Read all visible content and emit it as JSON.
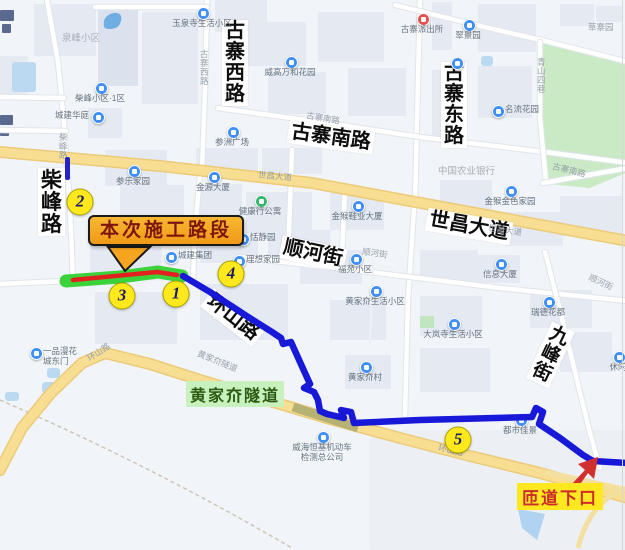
{
  "colors": {
    "route_blue": "#1818D8",
    "construction_red": "#E32020",
    "construction_glow_green": "#3BD23B",
    "callout_bg": "#F5A51F",
    "callout_text": "#7D1608",
    "badge_bg": "#FFE81C",
    "badge_text": "#1C1C66",
    "tunnel_label_bg": "#C8F1BE",
    "tunnel_label_text": "#2E5B13",
    "ramp_label_bg": "#FFE81F",
    "ramp_label_text": "#CB2B2B",
    "arrow_red": "#D23030"
  },
  "callout": {
    "text": "本次施工路段"
  },
  "tunnel": {
    "text": "黄家夼隧道"
  },
  "ramp": {
    "text": "匝道下口"
  },
  "badges": [
    {
      "n": "1",
      "x": 176,
      "y": 294
    },
    {
      "n": "2",
      "x": 80,
      "y": 202
    },
    {
      "n": "3",
      "x": 122,
      "y": 296
    },
    {
      "n": "4",
      "x": 231,
      "y": 274
    },
    {
      "n": "5",
      "x": 458,
      "y": 440
    }
  ],
  "major_road_labels": [
    {
      "t": "古寨西路",
      "x": 222,
      "y": 20,
      "v": true,
      "r": 0,
      "fs": 20
    },
    {
      "t": "古寨东路",
      "x": 441,
      "y": 62,
      "v": true,
      "r": 0,
      "fs": 20
    },
    {
      "t": "柴峰路",
      "x": 38,
      "y": 168,
      "v": true,
      "r": 0,
      "fs": 21
    },
    {
      "t": "古寨南路",
      "x": 288,
      "y": 126,
      "v": false,
      "r": 8,
      "fs": 20
    },
    {
      "t": "世昌大道",
      "x": 426,
      "y": 215,
      "v": false,
      "r": 10,
      "fs": 20
    },
    {
      "t": "顺河街",
      "x": 280,
      "y": 242,
      "v": false,
      "r": 12,
      "fs": 20
    },
    {
      "t": "环山路",
      "x": 200,
      "y": 306,
      "v": false,
      "r": 38,
      "fs": 20
    },
    {
      "t": "九峰街",
      "x": 538,
      "y": 324,
      "v": true,
      "r": 25,
      "fs": 19
    }
  ],
  "minor_road_labels": [
    {
      "t": "柴峰路",
      "x": 59,
      "y": 133,
      "r": 0,
      "v": true
    },
    {
      "t": "古寨西路",
      "x": 200,
      "y": 50,
      "r": 0,
      "v": true
    },
    {
      "t": "世昌大道",
      "x": 258,
      "y": 172,
      "r": 5,
      "v": false
    },
    {
      "t": "世昌大道",
      "x": 488,
      "y": 226,
      "r": 8,
      "v": false
    },
    {
      "t": "古寨南路",
      "x": 306,
      "y": 114,
      "r": 10,
      "v": false
    },
    {
      "t": "古寨南路",
      "x": 552,
      "y": 166,
      "r": 14,
      "v": false
    },
    {
      "t": "顺河街",
      "x": 362,
      "y": 249,
      "r": 8,
      "v": false
    },
    {
      "t": "顺河街",
      "x": 588,
      "y": 278,
      "r": 25,
      "v": false
    },
    {
      "t": "环山路",
      "x": 86,
      "y": 348,
      "r": -33,
      "v": false
    },
    {
      "t": "环山路",
      "x": 438,
      "y": 446,
      "r": 12,
      "v": false
    },
    {
      "t": "黄家夼隧道",
      "x": 196,
      "y": 357,
      "r": 22,
      "v": false
    },
    {
      "t": "青山四巷",
      "x": 537,
      "y": 58,
      "r": 0,
      "v": true
    },
    {
      "t": "草寨园",
      "x": 588,
      "y": 23,
      "r": 0,
      "v": false
    }
  ],
  "area_labels": [
    {
      "t": "泉峰小区",
      "x": 62,
      "y": 30
    },
    {
      "t": "中国农业银行",
      "x": 438,
      "y": 163
    }
  ],
  "pois": [
    {
      "lines": [
        "玉泉寺生活小区"
      ],
      "x": 202,
      "y": 12,
      "c": "blue",
      "p": "below"
    },
    {
      "lines": [
        "柴峰小区·1区"
      ],
      "x": 100,
      "y": 87,
      "c": "blue",
      "p": "below"
    },
    {
      "lines": [
        "城建华庭"
      ],
      "x": 97,
      "y": 116,
      "c": "blue",
      "p": "left"
    },
    {
      "lines": [
        "威高万和花园"
      ],
      "x": 290,
      "y": 61,
      "c": "blue",
      "p": "below"
    },
    {
      "lines": [
        "古寨派出所"
      ],
      "x": 422,
      "y": 18,
      "c": "red",
      "p": "below"
    },
    {
      "lines": [
        "翠景园"
      ],
      "x": 468,
      "y": 24,
      "c": "blue",
      "p": "below"
    },
    {
      "lines": [],
      "x": 456,
      "y": 62,
      "c": "blue",
      "p": "below"
    },
    {
      "lines": [
        "名流花园"
      ],
      "x": 497,
      "y": 110,
      "c": "blue",
      "p": "right"
    },
    {
      "lines": [
        "参洲广场"
      ],
      "x": 232,
      "y": 131,
      "c": "blue",
      "p": "below"
    },
    {
      "lines": [
        "参乐家园"
      ],
      "x": 133,
      "y": 170,
      "c": "blue",
      "p": "below"
    },
    {
      "lines": [
        "金源大厦"
      ],
      "x": 213,
      "y": 176,
      "c": "blue",
      "p": "below"
    },
    {
      "lines": [
        "金猴鞋业大厦"
      ],
      "x": 357,
      "y": 205,
      "c": "blue",
      "p": "below"
    },
    {
      "lines": [
        "金猴金色家园"
      ],
      "x": 510,
      "y": 190,
      "c": "blue",
      "p": "below"
    },
    {
      "lines": [
        "健康行公寓"
      ],
      "x": 260,
      "y": 200,
      "c": "green",
      "p": "below"
    },
    {
      "lines": [
        "恬静园"
      ],
      "x": 242,
      "y": 238,
      "c": "blue",
      "p": "right"
    },
    {
      "lines": [
        "理想家园"
      ],
      "x": 238,
      "y": 260,
      "c": "blue",
      "p": "right"
    },
    {
      "lines": [
        "城建集团"
      ],
      "x": 170,
      "y": 256,
      "c": "blue",
      "p": "right"
    },
    {
      "lines": [
        "福苑小区"
      ],
      "x": 355,
      "y": 258,
      "c": "blue",
      "p": "below"
    },
    {
      "lines": [
        "信息大厦"
      ],
      "x": 500,
      "y": 263,
      "c": "blue",
      "p": "below"
    },
    {
      "lines": [
        "瑞德花都"
      ],
      "x": 548,
      "y": 301,
      "c": "blue",
      "p": "below"
    },
    {
      "lines": [
        "黄家夼生活小区"
      ],
      "x": 375,
      "y": 290,
      "c": "blue",
      "p": "below"
    },
    {
      "lines": [
        "大岚寺生活小区"
      ],
      "x": 453,
      "y": 323,
      "c": "blue",
      "p": "below"
    },
    {
      "lines": [
        "黄家夼村"
      ],
      "x": 365,
      "y": 366,
      "c": "blue",
      "p": "below"
    },
    {
      "lines": [
        "都市佳景"
      ],
      "x": 520,
      "y": 419,
      "c": "blue",
      "p": "below"
    },
    {
      "lines": [
        "威海恒基机动车",
        "检测总公司"
      ],
      "x": 322,
      "y": 436,
      "c": "blue",
      "p": "below"
    },
    {
      "lines": [
        "一品漫花",
        "城东门"
      ],
      "x": 35,
      "y": 352,
      "c": "blue",
      "p": "right"
    },
    {
      "lines": [
        "休闲"
      ],
      "x": 618,
      "y": 356,
      "c": "blue",
      "p": "below"
    }
  ],
  "route": {
    "points": [
      [
        183,
        276
      ],
      [
        210,
        292
      ],
      [
        245,
        315
      ],
      [
        272,
        332
      ],
      [
        281,
        338
      ],
      [
        283,
        344
      ],
      [
        291,
        342
      ],
      [
        300,
        362
      ],
      [
        310,
        384
      ],
      [
        304,
        388
      ],
      [
        314,
        392
      ],
      [
        318,
        400
      ],
      [
        320,
        411
      ],
      [
        327,
        414
      ],
      [
        344,
        418
      ],
      [
        341,
        410
      ],
      [
        351,
        412
      ],
      [
        354,
        423
      ],
      [
        420,
        420
      ],
      [
        532,
        417
      ],
      [
        536,
        408
      ],
      [
        543,
        412
      ],
      [
        539,
        424
      ],
      [
        560,
        438
      ],
      [
        583,
        455
      ],
      [
        593,
        461
      ],
      [
        628,
        463
      ]
    ]
  },
  "construction": {
    "green": [
      [
        66,
        281
      ],
      [
        120,
        277
      ],
      [
        158,
        272
      ],
      [
        182,
        276
      ]
    ],
    "red": [
      [
        73,
        280
      ],
      [
        157,
        272
      ],
      [
        177,
        275
      ]
    ]
  },
  "ramp_arrow_points": "570,486 585,470 578,464 598,457 594,479 588,473 576,490",
  "callout_pointer_points": "108,247 150,247 125,271"
}
